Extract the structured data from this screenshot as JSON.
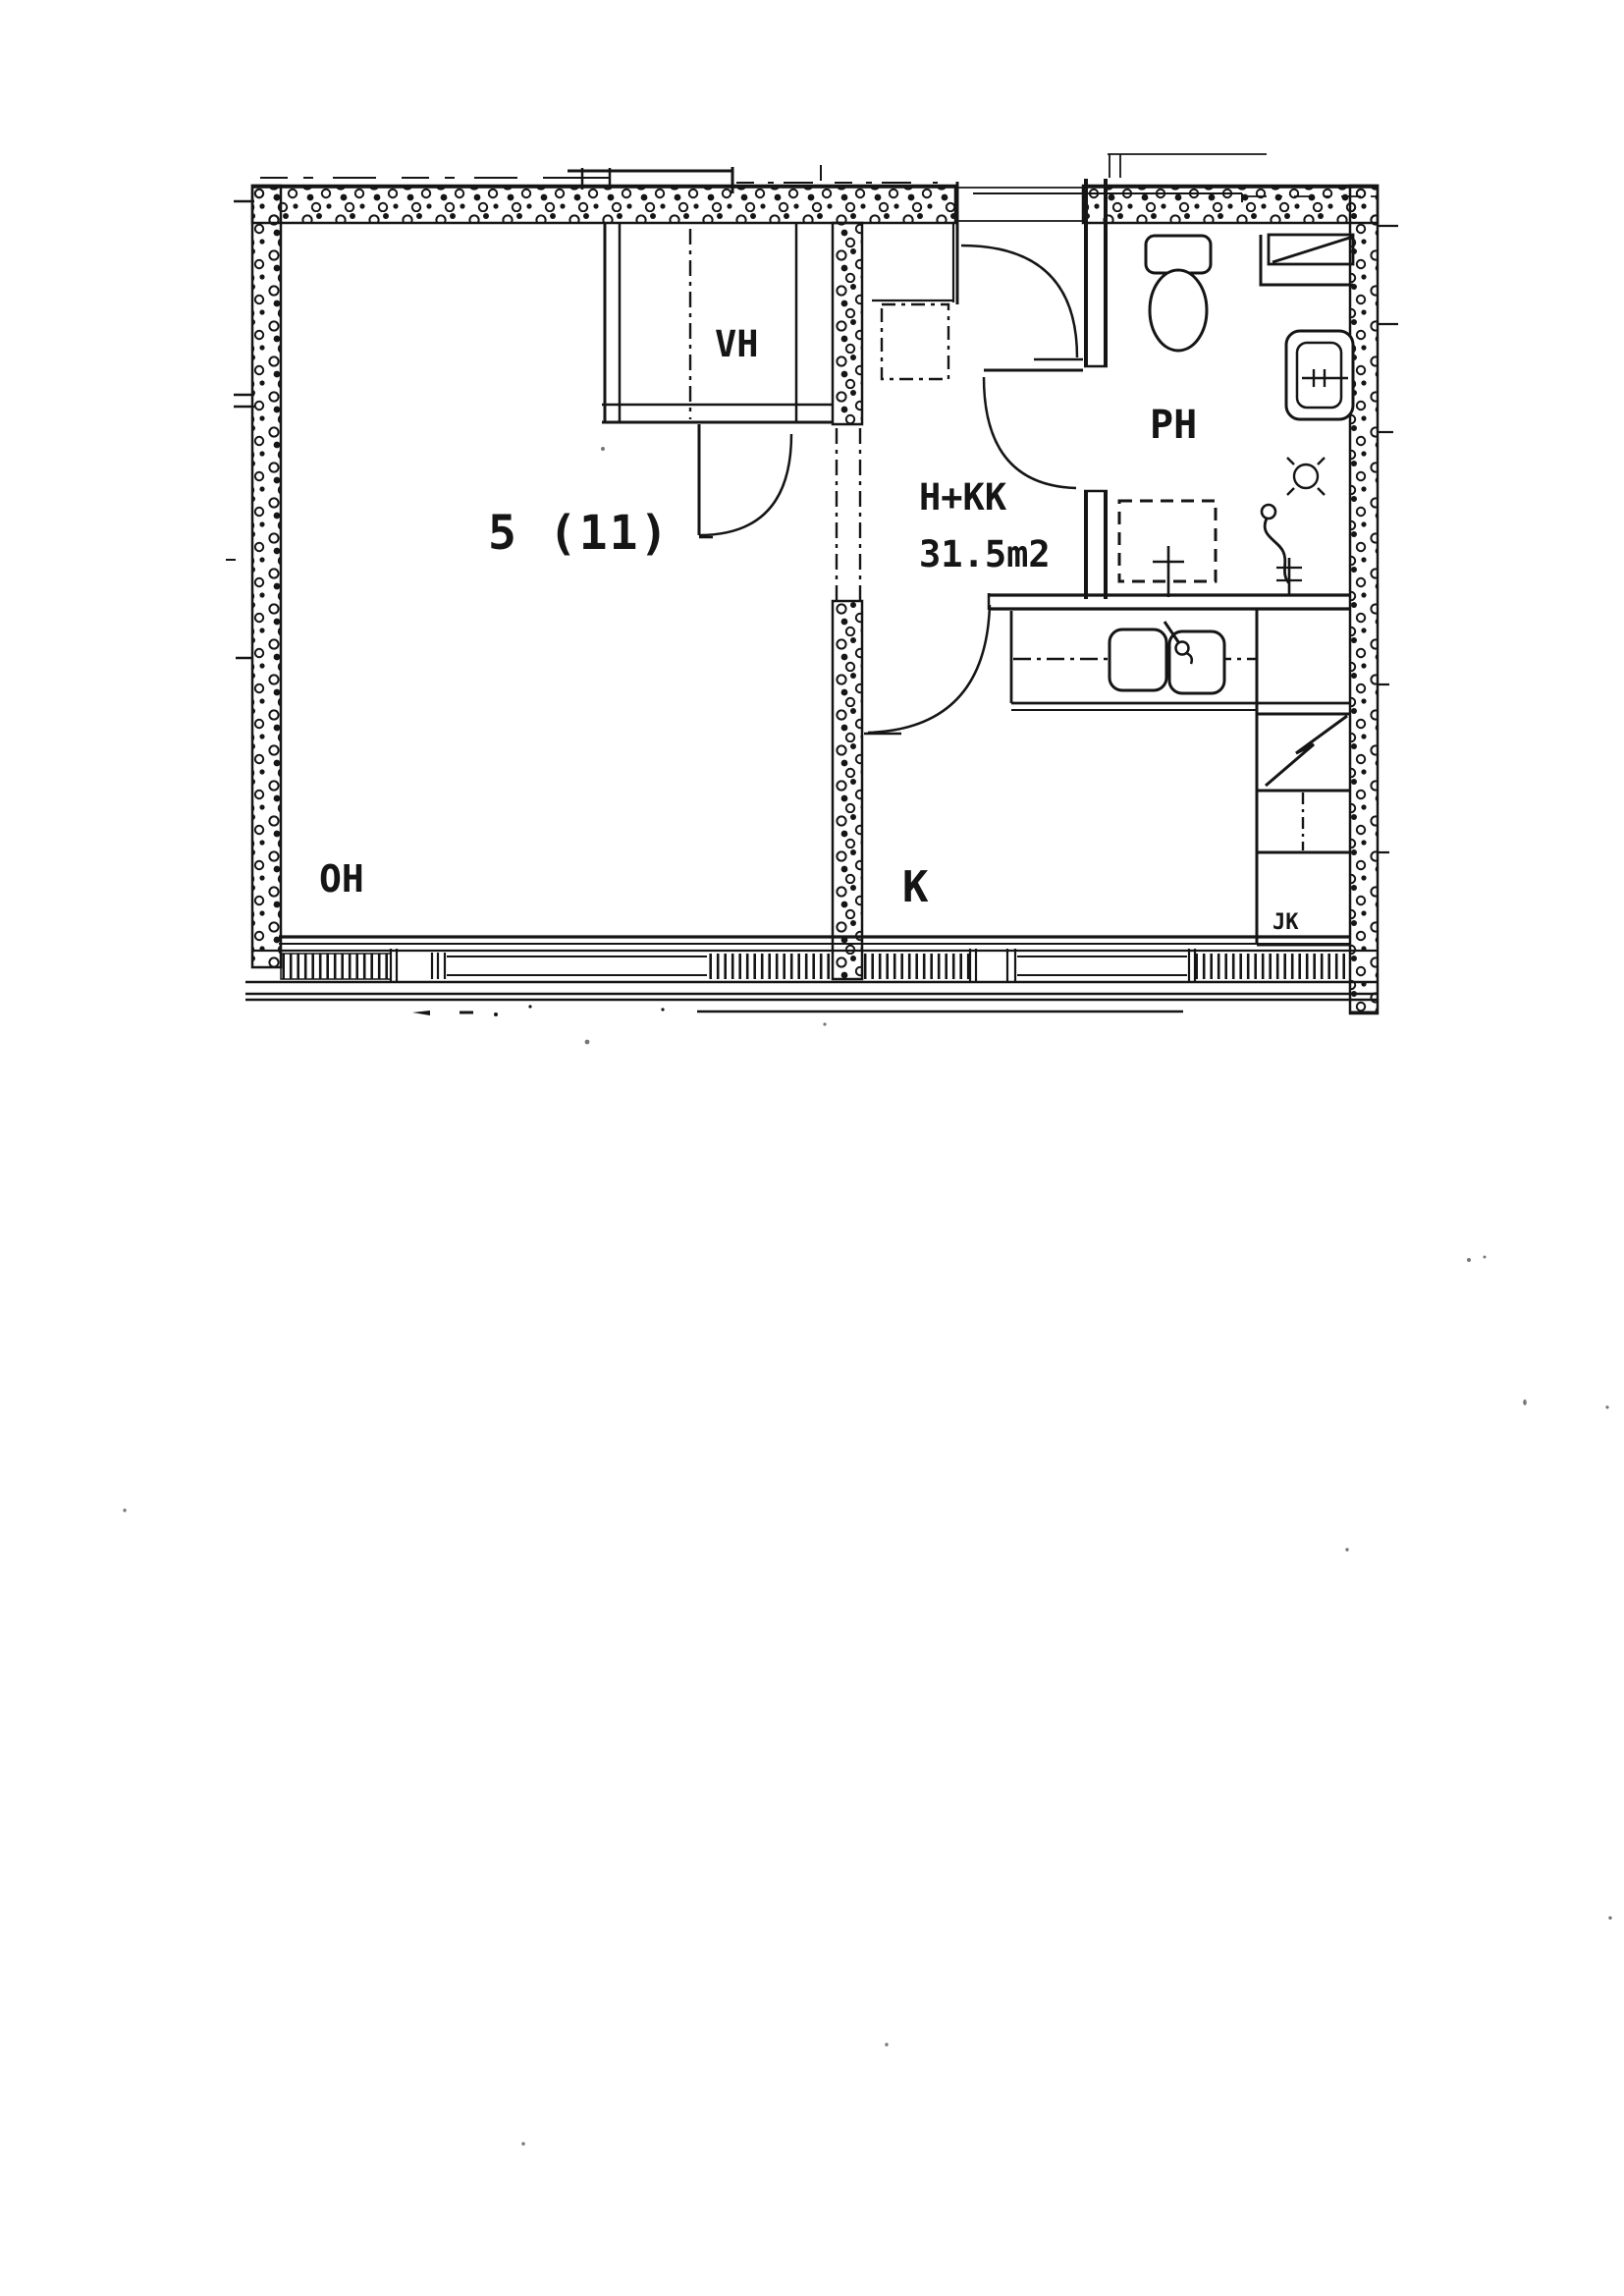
{
  "page": {
    "background": "#ffffff",
    "ink": "#151515",
    "kind": "scanned floor plan"
  },
  "plan": {
    "unit_number": "5 (11)",
    "unit_type": "H+KK",
    "unit_area": "31.5m2",
    "rooms": [
      {
        "label": "VH"
      },
      {
        "label": "PH"
      },
      {
        "label": "OH"
      },
      {
        "label": "K"
      },
      {
        "label": "JK"
      }
    ],
    "fixture_icons": [
      "toilet-icon",
      "shower-corner-icon",
      "washbasin-icon",
      "floor-drain-icon",
      "water-heater-icon",
      "washing-machine-reservation-icon",
      "double-sink-icon",
      "faucet-icon",
      "electric-cabinet-icon",
      "fridge-box-icon",
      "wardrobe-icon",
      "door-swing-icon",
      "window-band-icon"
    ]
  }
}
